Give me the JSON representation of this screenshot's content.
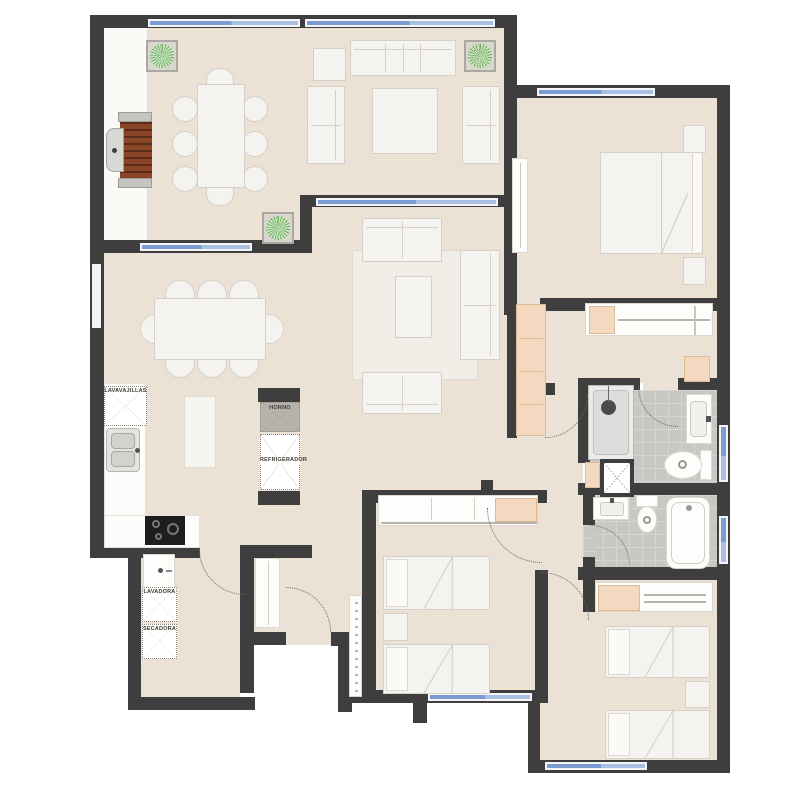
{
  "plan": {
    "kind": "apartment-floor-plan",
    "appliance_labels": {
      "dishwasher": "LAVAVAJILLAS",
      "oven": "HORNO",
      "refrigerator": "REFRIGERADOR",
      "washer": "LAVADORA",
      "dryer": "SECADORA"
    },
    "colors": {
      "wall": "#3e3e3e",
      "floor": "#ebe2d5",
      "walkway": "#fbfaf7",
      "rug": "#f1eee8",
      "tile": "#c9c7c4",
      "tile_line": "#d7d5d2",
      "window_glass": "#7b9cd3",
      "window_glass_light": "#a9c0e4",
      "window_casing": "#f3f5f8",
      "closet_wood": "#f3d9bf",
      "closet_wood_line": "#dcba92",
      "plant_green": "#6fae5f",
      "plant_green_light": "#cfe4c4",
      "grill_wood": "#8a4426",
      "furniture_fill": "#f5f3ef",
      "furniture_line": "#d5d1c9",
      "cooktop": "#1e1e1e",
      "arc": "#6b665e",
      "label_text": "#3f3b35"
    }
  }
}
